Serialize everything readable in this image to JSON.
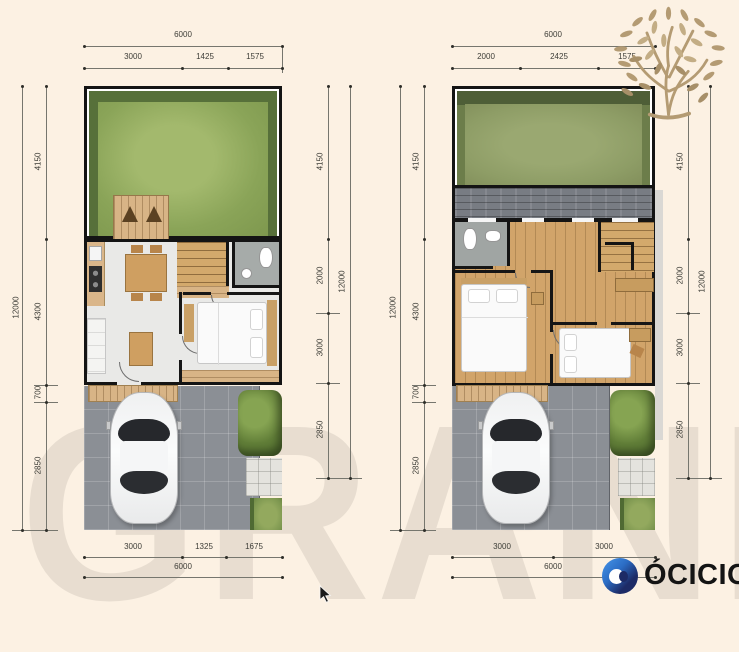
{
  "background": "#fcf1e3",
  "watermark": {
    "text": "GRAND"
  },
  "branding": {
    "logo_text": "ÓCICIO",
    "logo_icon": "blue-eye-circle",
    "logo_navy": "#1d2b66",
    "logo_blue": "#2f7ad0",
    "tree_icon_color": "#b49b73"
  },
  "floor1": {
    "top": {
      "total": "6000",
      "segments": [
        "3000",
        "1425",
        "1575"
      ]
    },
    "bottom": {
      "total": "6000",
      "segments": [
        "3000",
        "1325",
        "1675"
      ]
    },
    "left": {
      "total": "12000",
      "segments": [
        "4150",
        "4300",
        "700",
        "2850"
      ]
    },
    "right": {
      "total": "12000",
      "segments": [
        "4150",
        "2000",
        "3000",
        "2850"
      ]
    }
  },
  "floor2": {
    "top": {
      "total": "6000",
      "segments": [
        "2000",
        "2425",
        "1575"
      ]
    },
    "bottom": {
      "total": "6000",
      "segments": [
        "3000",
        "3000"
      ]
    },
    "left": {
      "total": "12000",
      "segments": [
        "4150",
        "4300",
        "700",
        "2850"
      ]
    },
    "right": {
      "total": "12000",
      "segments": [
        "4150",
        "2000",
        "3000",
        "2850"
      ]
    }
  },
  "colors": {
    "background": "#fcf1e3",
    "grass_bright": "#8fa958",
    "grass_olive": "#8e9d66",
    "hedge": "#4f6a33",
    "wood": "#d2a76b",
    "carport": "#8b8f95",
    "wall": "#161616",
    "dim_text": "#3d3d37"
  }
}
